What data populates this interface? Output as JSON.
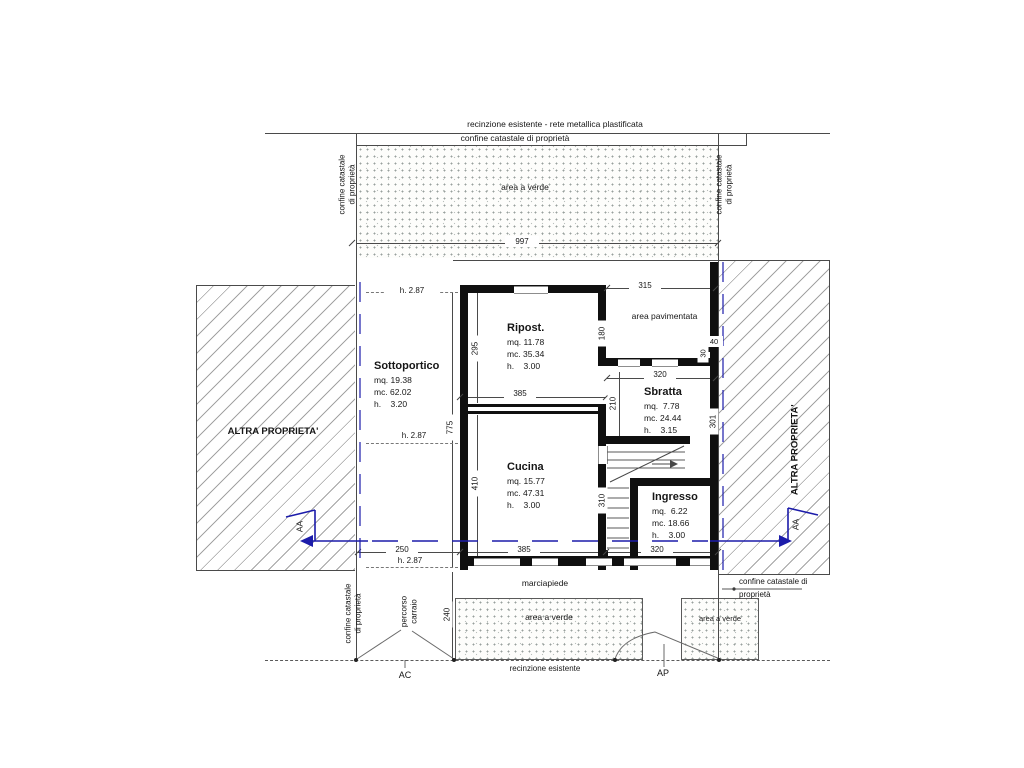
{
  "labels": {
    "fence_top": "recinzione esistente - rete metallica plastificata",
    "confine_top": "confine catastale di proprietà",
    "area_verde_top": "area a verde",
    "confine_left_vert": "confine catastale di proprietà",
    "confine_right_vert": "confine catastale di proprietà",
    "altra_sinistra": "ALTRA PROPRIETA'",
    "altra_destra": "ALTRA PROPRIETA'",
    "area_pavimentata": "area pavimentata",
    "marciapiede": "marciapiede",
    "percorso_carraio": "percorso carraio",
    "confine_bottom_left": "confine catastale di proprietà",
    "confine_bottom_right": "confine catastale di proprietà",
    "area_verde_bottom_left": "area a verde",
    "area_verde_bottom_right": "area a verde",
    "recinzione_bottom": "recinzione esistente",
    "gate_ac": "AC",
    "gate_ap": "AP",
    "section_left": "AA",
    "section_right": "AA"
  },
  "rooms": {
    "sottoportico": {
      "name": "Sottoportico",
      "mq": "mq. 19.38",
      "mc": "mc. 62.02",
      "h": "h.    3.20"
    },
    "ripostiglio": {
      "name": "Ripost.",
      "mq": "mq. 11.78",
      "mc": "mc. 35.34",
      "h": "h.    3.00"
    },
    "sbratta": {
      "name": "Sbratta",
      "mq": "mq.  7.78",
      "mc": "mc. 24.44",
      "h": "h.    3.15"
    },
    "cucina": {
      "name": "Cucina",
      "mq": "mq. 15.77",
      "mc": "mc. 47.31",
      "h": "h.    3.00"
    },
    "ingresso": {
      "name": "Ingresso",
      "mq": "mq.  6.22",
      "mc": "mc. 18.66",
      "h": "h.    3.00"
    }
  },
  "dims": {
    "d997": "997",
    "d315": "315",
    "d180": "180",
    "d40": "40",
    "d30": "30",
    "d320_sbratta": "320",
    "d210": "210",
    "d301": "301",
    "d295": "295",
    "d385_mid": "385",
    "d775": "775",
    "d410": "410",
    "d310": "310",
    "d250": "250",
    "d385_bottom": "385",
    "d320_bottom": "320",
    "d240": "240",
    "h287_top": "h. 2.87",
    "h287_mid": "h. 2.87",
    "h287_bottom": "h. 2.87"
  },
  "colors": {
    "section_blue": "#1c1caa",
    "line": "#4a4a4a",
    "wall": "#101010"
  }
}
